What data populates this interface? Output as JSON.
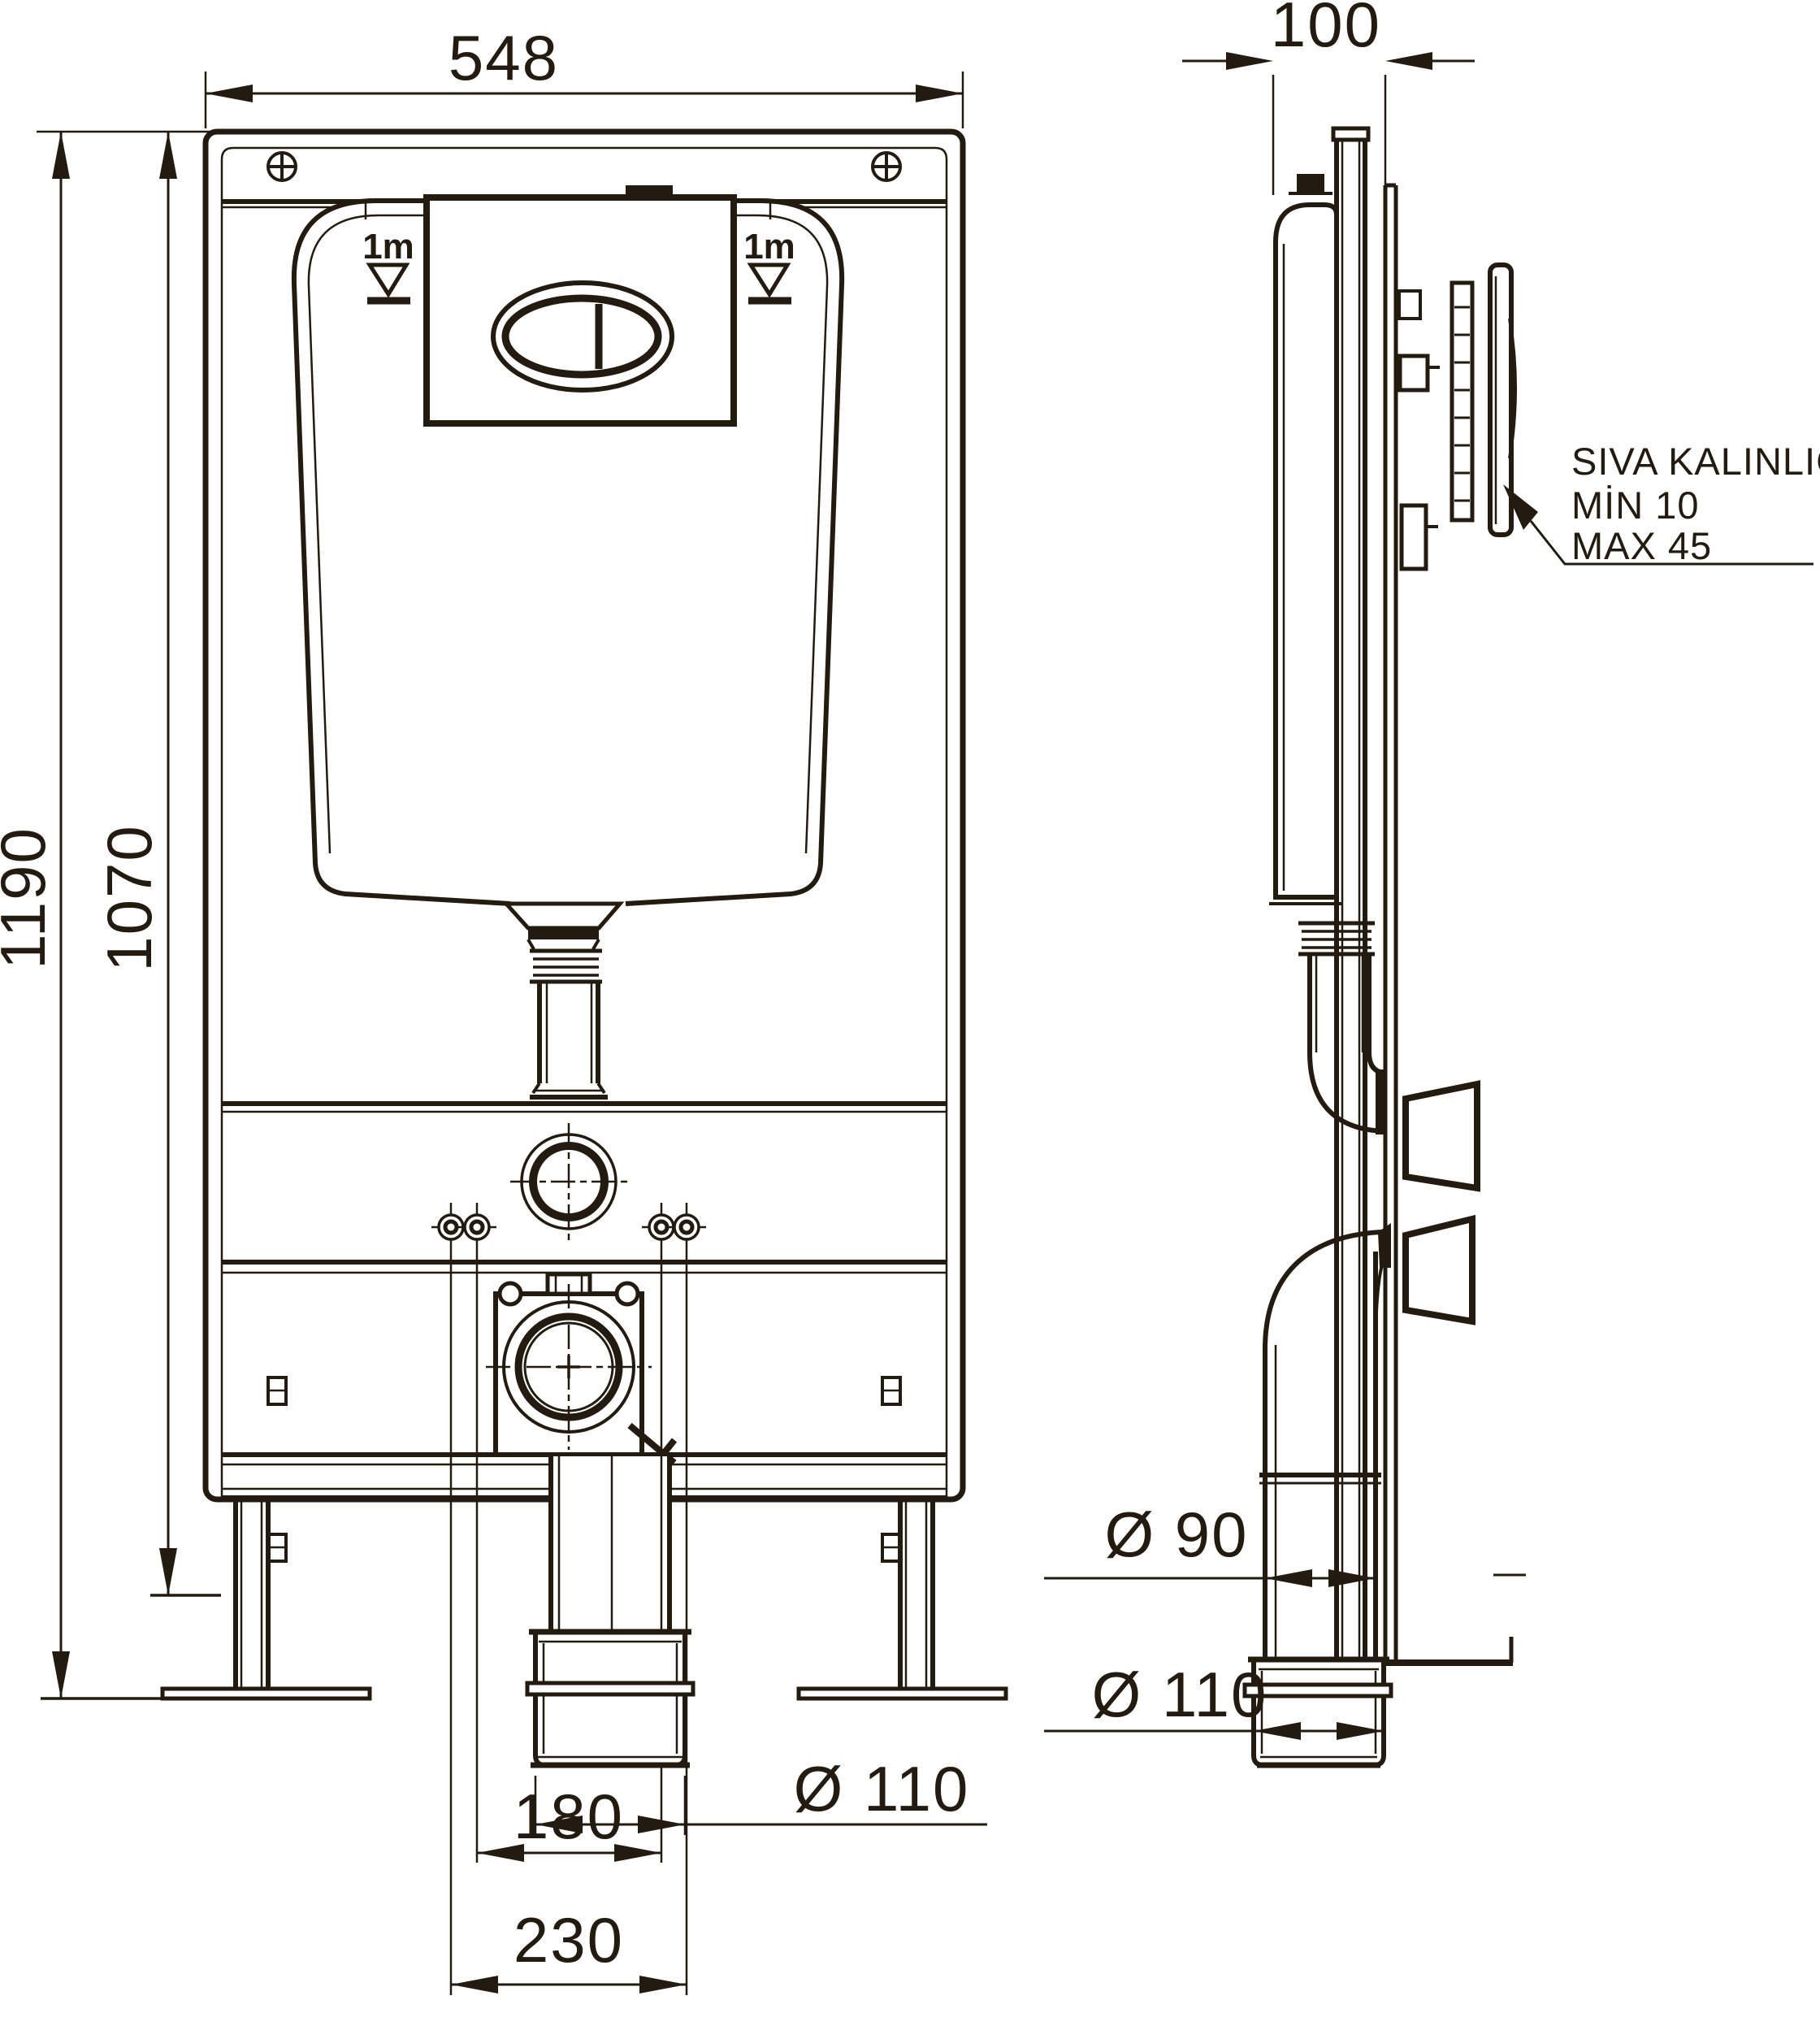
{
  "drawing_title": "concealed-cistern-wc-frame-installation-drawing",
  "colors": {
    "line": "#231a10",
    "background": "#ffffff"
  },
  "front_view": {
    "dim_width": "548",
    "dim_height_total": "1190",
    "dim_height_inner": "1070",
    "level_mark_left": "1m",
    "level_mark_right": "1m",
    "dim_outlet_diameter": "Ø 110",
    "dim_fixing_inner": "180",
    "dim_fixing_outer": "230"
  },
  "side_view": {
    "dim_depth": "100",
    "dim_pipe_diameter": "Ø 90",
    "dim_adapter_diameter": "Ø 110",
    "plaster_note": {
      "line1": "SIVA KALINLIĞI",
      "line2": "MİN  10",
      "line3": "MAX 45"
    }
  }
}
